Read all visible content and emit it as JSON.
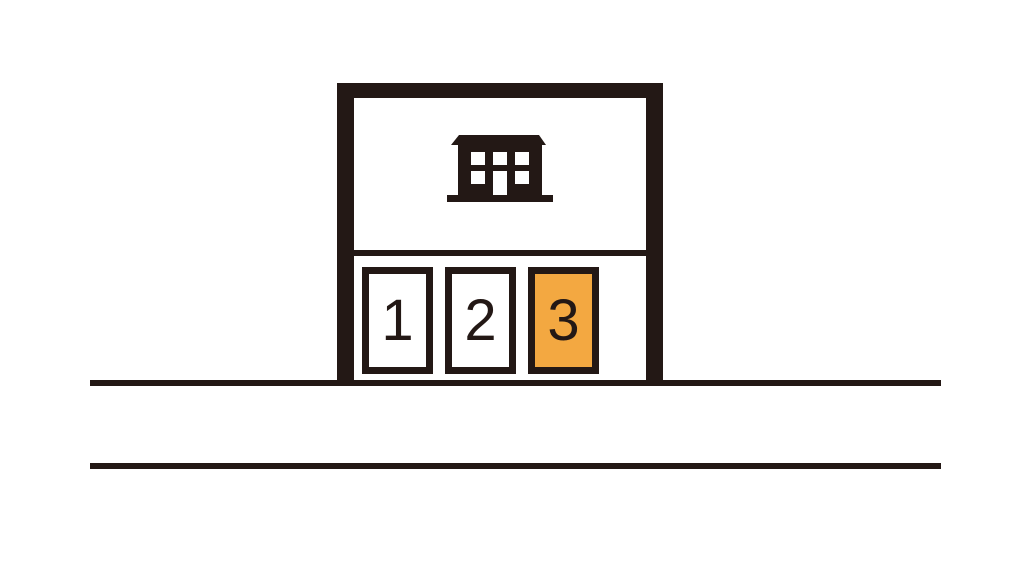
{
  "page": {
    "background": "#ffffff",
    "ink_color": "#231815",
    "highlight_color": "#f3a841"
  },
  "map": {
    "type": "parking-lot-map",
    "building": {
      "icon": "building-icon"
    },
    "spaces": [
      {
        "label": "1",
        "fill": "#ffffff",
        "selected": false
      },
      {
        "label": "2",
        "fill": "#ffffff",
        "selected": false
      },
      {
        "label": "3",
        "fill": "#f3a841",
        "selected": true
      }
    ],
    "road": {
      "line_count": 2
    }
  }
}
